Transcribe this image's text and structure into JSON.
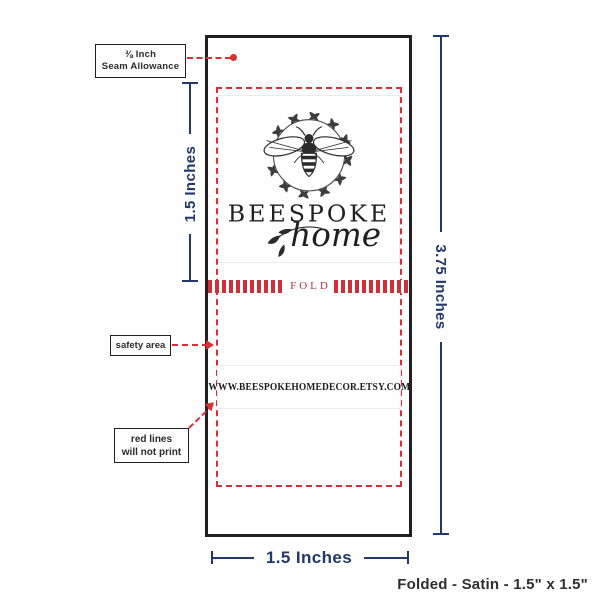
{
  "colors": {
    "accent_navy": "#21386b",
    "accent_red": "#d93036",
    "outline_black": "#231f20"
  },
  "label": {
    "brand": "BEESPOKE",
    "brand_script": "home",
    "fold_text": "FOLD",
    "website": "WWW.BEESPOKEHOMEDECOR.ETSY.COM"
  },
  "measurements": {
    "total_height": "3.75 Inches",
    "front_panel_height": "1.5 Inches",
    "width": "1.5 Inches"
  },
  "callouts": {
    "seam_line1": "⅜ Inch",
    "seam_line2": "Seam Allowance",
    "safety_area": "safety area",
    "red_lines_line1": "red lines",
    "red_lines_line2": "will not print"
  },
  "footer": {
    "caption": "Folded - Satin - 1.5\" x 1.5\""
  }
}
